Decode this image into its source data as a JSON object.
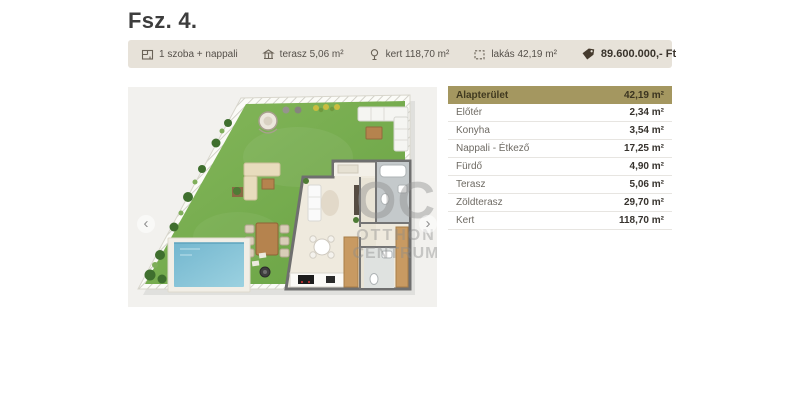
{
  "page": {
    "title": "Fsz. 4."
  },
  "infobar": {
    "items": [
      {
        "icon": "room-icon",
        "label": "1 szoba + nappali"
      },
      {
        "icon": "terrace-icon",
        "label": "terasz 5,06 m²"
      },
      {
        "icon": "garden-icon",
        "label": "kert 118,70 m²"
      },
      {
        "icon": "area-icon",
        "label": "lakás 42,19 m²"
      }
    ],
    "price": {
      "icon": "price-tag-icon",
      "label": "89.600.000,- Ft"
    }
  },
  "carousel": {
    "prev_label": "‹",
    "next_label": "›",
    "watermark": {
      "line1": "OC",
      "line2": "OTTHON",
      "line3": "CENTRUM"
    }
  },
  "room_table": {
    "header": {
      "label": "Alapterület",
      "value": "42,19 m²"
    },
    "rows": [
      {
        "label": "Előtér",
        "value": "2,34 m²"
      },
      {
        "label": "Konyha",
        "value": "3,54 m²"
      },
      {
        "label": "Nappali - Étkező",
        "value": "17,25 m²"
      },
      {
        "label": "Fürdő",
        "value": "4,90 m²"
      },
      {
        "label": "Terasz",
        "value": "5,06 m²"
      },
      {
        "label": "Zöldterasz",
        "value": "29,70 m²"
      },
      {
        "label": "Kert",
        "value": "118,70 m²"
      }
    ]
  },
  "colors": {
    "infobar_bg": "#e7e2d9",
    "table_header_bg": "#a49760",
    "price_tag": "#463b2e",
    "grass": "#74ab4c",
    "pool_water": "#7fc0d6",
    "image_bg": "#f2f1ee"
  }
}
